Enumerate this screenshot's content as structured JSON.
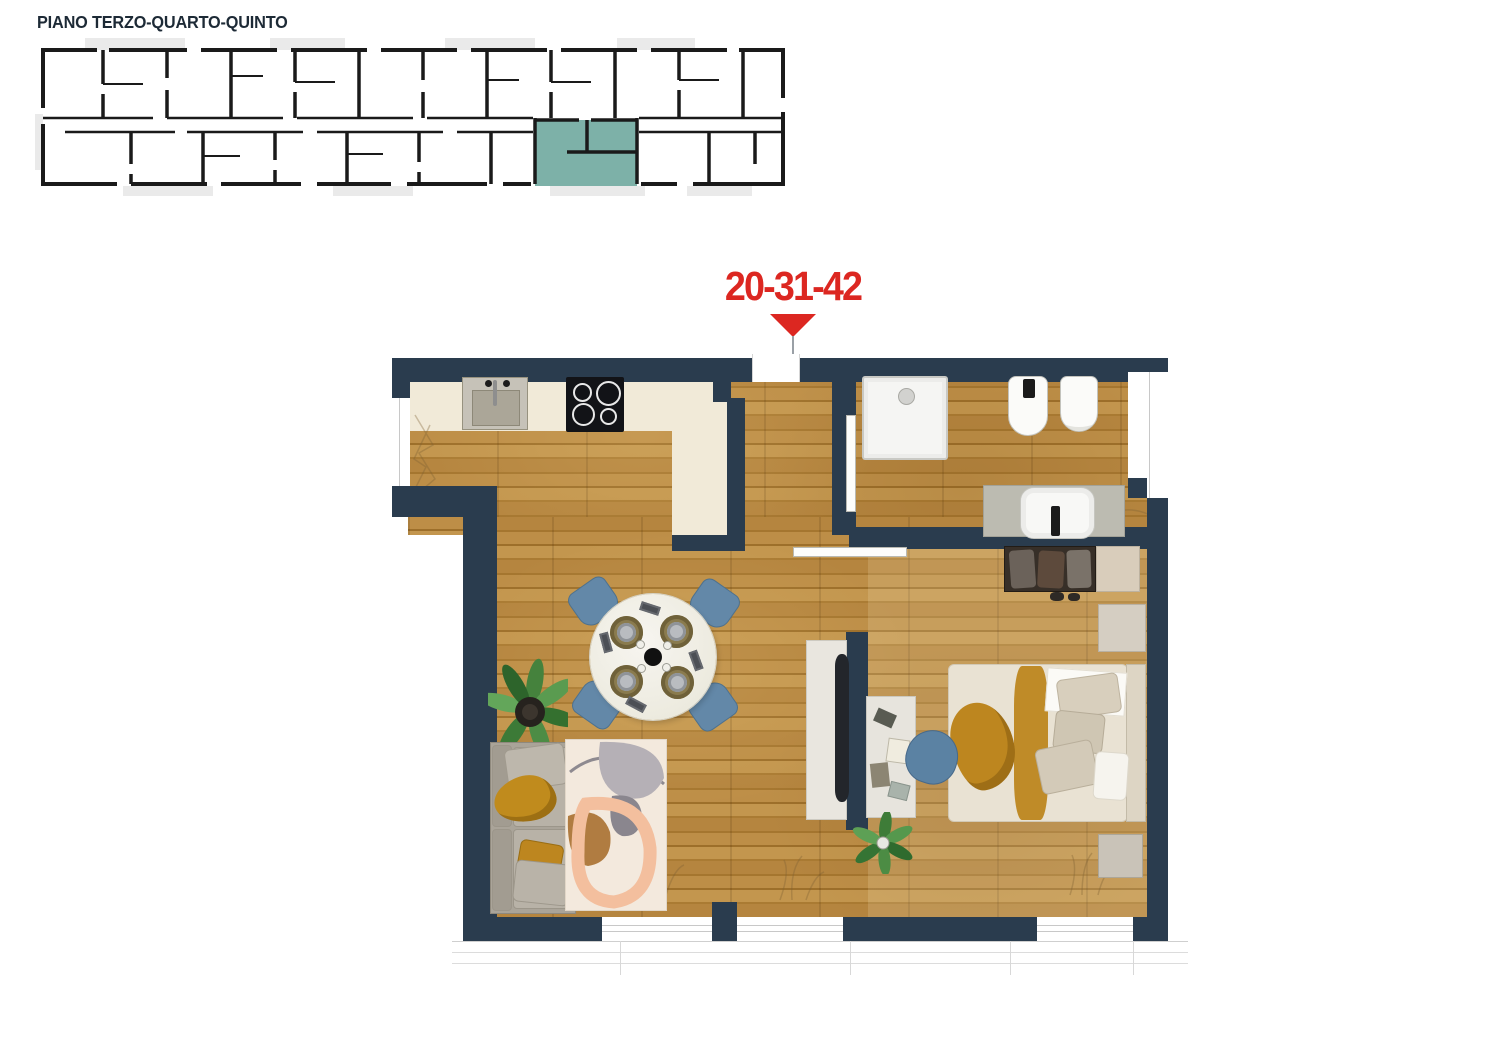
{
  "header": {
    "title": "PIANO TERZO-QUARTO-QUINTO"
  },
  "unit_callout": {
    "label": "20-31-42",
    "pointer_icon": "triangle-down-icon"
  },
  "overview_plan": {
    "type": "building-floor-overview",
    "highlighted_unit_label": "20-31-42"
  },
  "apartment_plan": {
    "fixtures": [
      "kitchen-sink",
      "induction-cooktop",
      "shower",
      "bidet",
      "toilet",
      "washbasin"
    ],
    "furniture": [
      "wardrobe",
      "nightstand",
      "double-bed",
      "bed-bench",
      "desk",
      "desk-chair",
      "tv",
      "tv-console",
      "dining-table",
      "dining-chair",
      "sofa",
      "rug",
      "potted-plant"
    ]
  },
  "colors": {
    "title_ink": "#1d2a36",
    "callout_red": "#dc2721",
    "wall_navy": "#2a3c4e",
    "unit_highlight_teal": "#7db1a8",
    "wood_floor": "#b08138",
    "kitchen_cream": "#f1ead8",
    "plan_line_black": "#1a1a1a",
    "balcony_gray": "#eaeaea",
    "accent_mustard": "#bd861f",
    "chair_blue": "#6388a8",
    "rug_cream": "#f3e9dd"
  }
}
